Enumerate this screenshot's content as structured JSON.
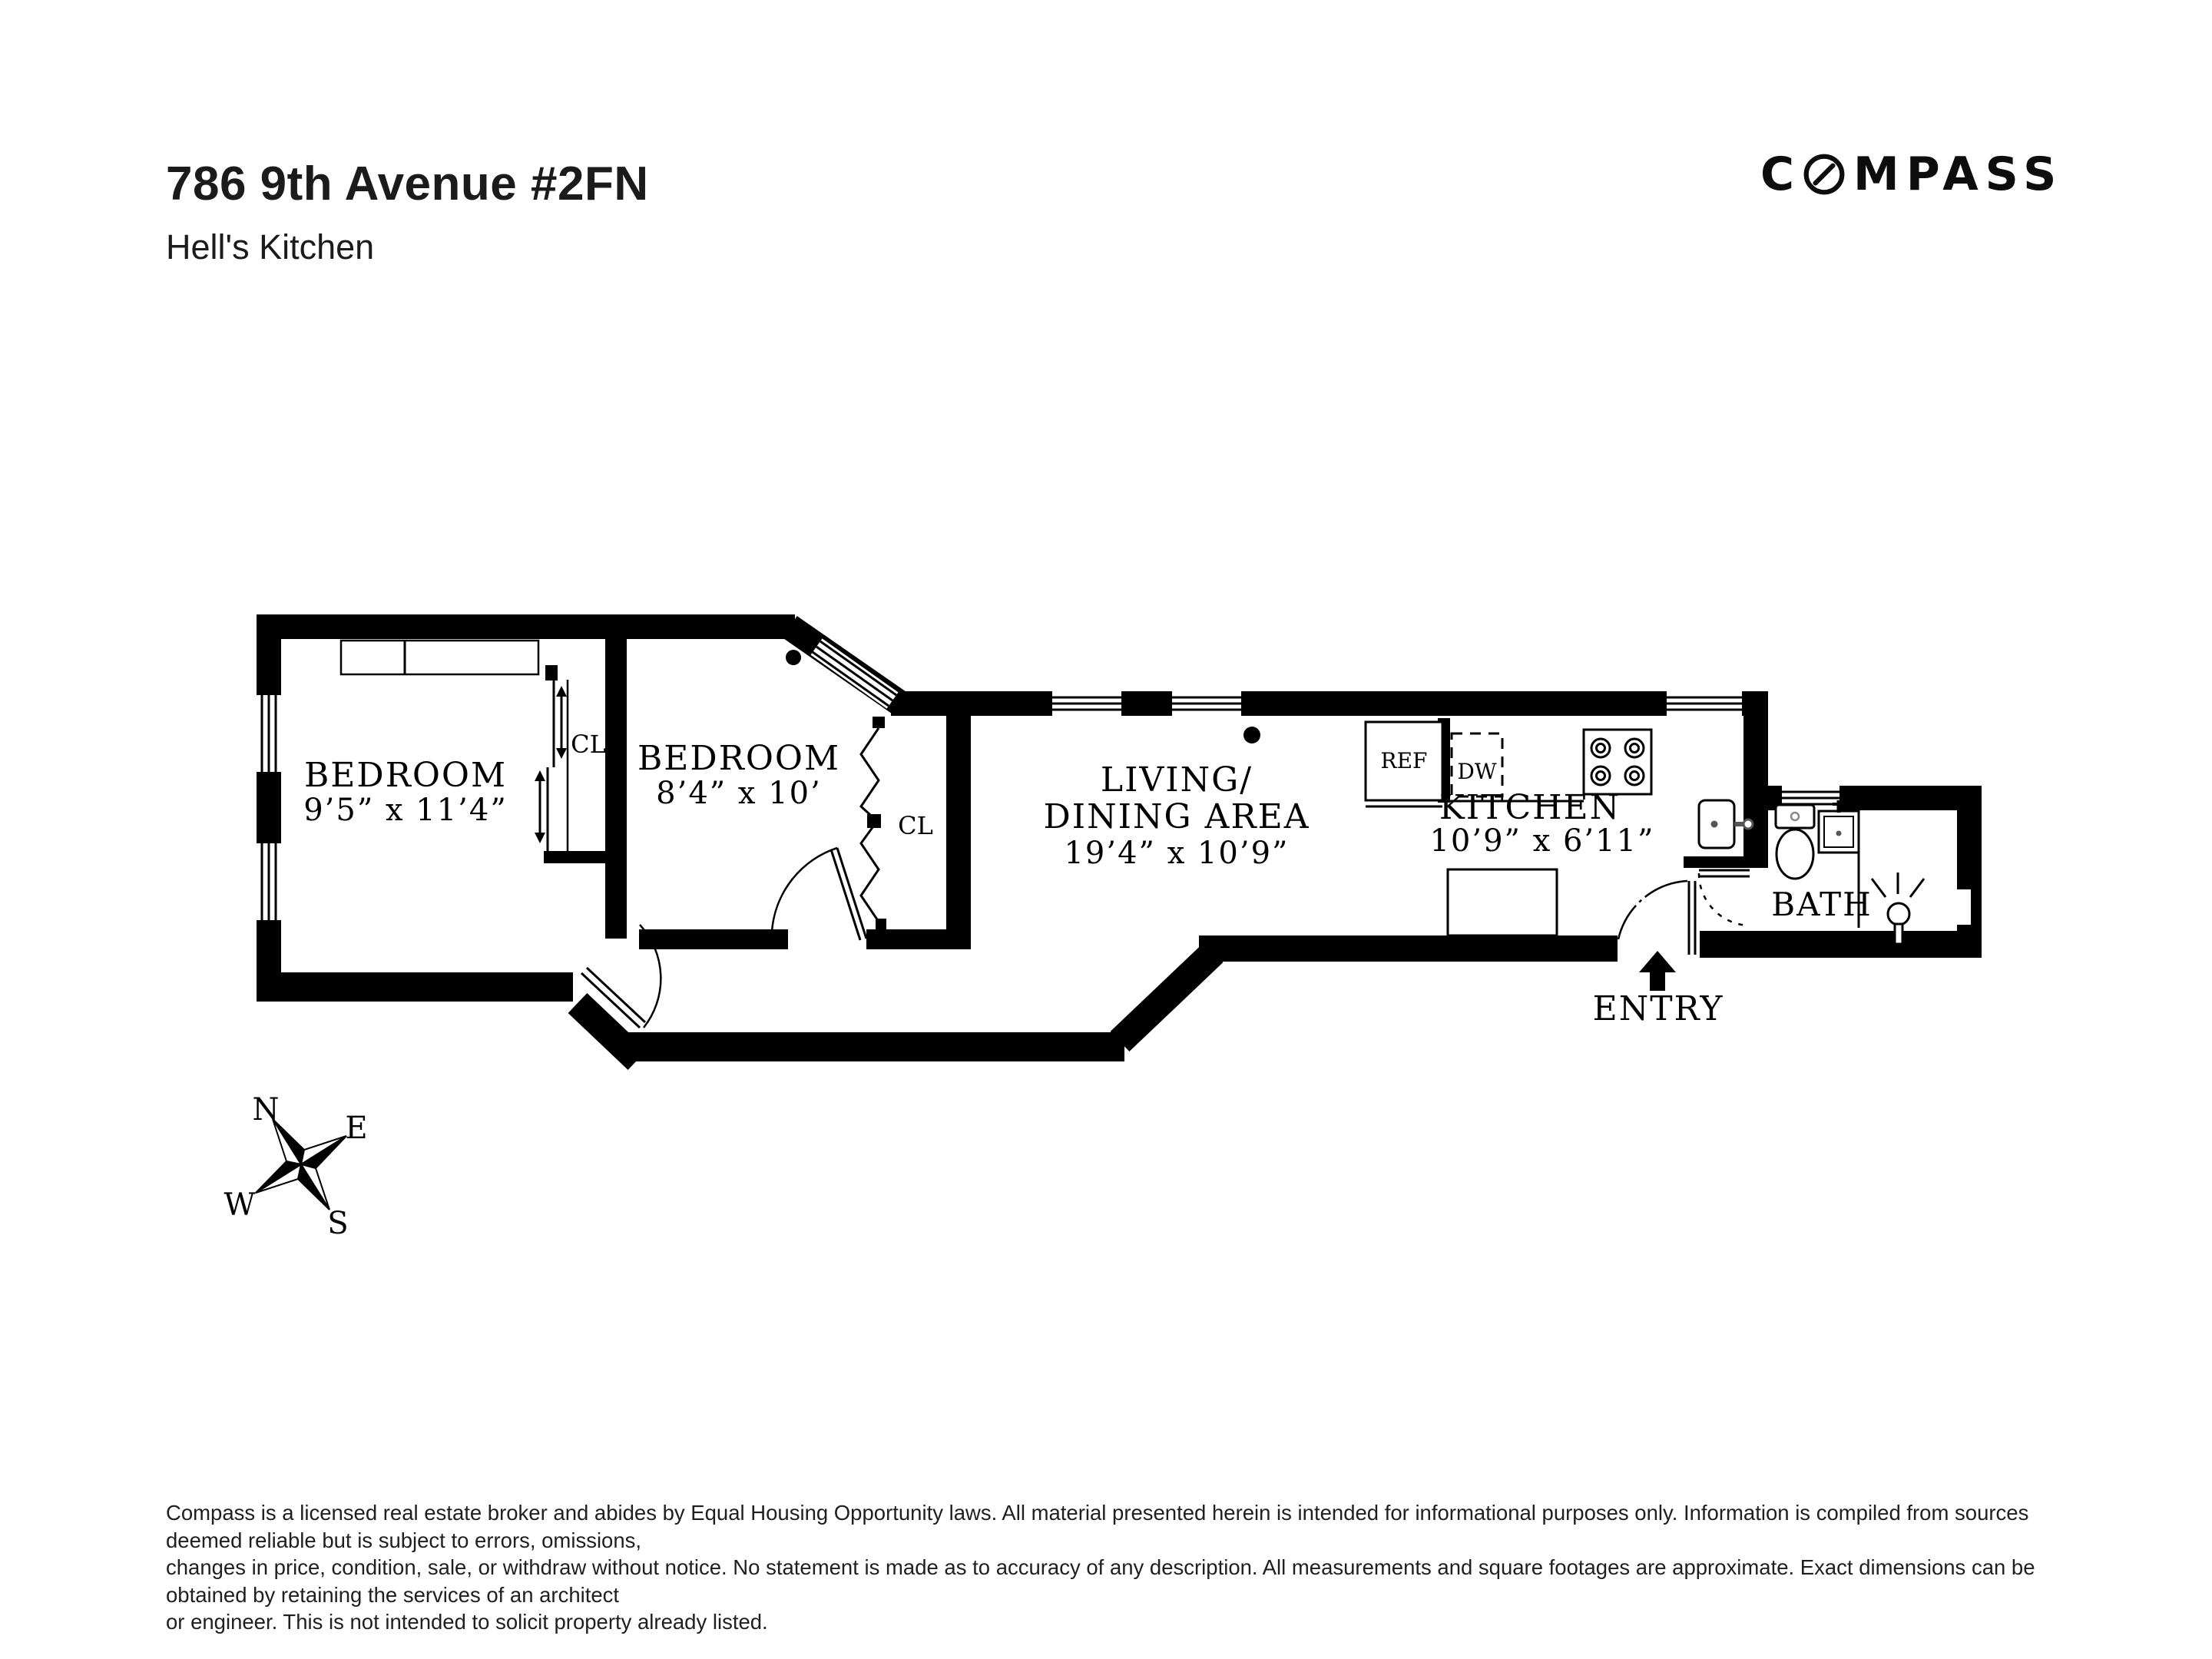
{
  "header": {
    "address": "786 9th Avenue #2FN",
    "neighborhood": "Hell's Kitchen"
  },
  "brand": {
    "logo_prefix": "C",
    "logo_suffix": "MPASS"
  },
  "floorplan": {
    "rooms": {
      "bedroom1": {
        "name": "BEDROOM",
        "dims": "9’5” x 11’4”"
      },
      "bedroom2": {
        "name": "BEDROOM",
        "dims": "8’4” x 10’"
      },
      "living": {
        "name_line1": "LIVING/",
        "name_line2": "DINING AREA",
        "dims": "19’4” x 10’9”"
      },
      "kitchen": {
        "name": "KITCHEN",
        "dims": "10’9” x 6’11”"
      },
      "bath": {
        "name": "BATH"
      }
    },
    "labels": {
      "closet_a": "CL",
      "closet_b": "CL",
      "refrigerator": "REF",
      "dishwasher": "DW",
      "entry": "ENTRY"
    },
    "compass_rose": {
      "n": "N",
      "e": "E",
      "s": "S",
      "w": "W"
    }
  },
  "footer": {
    "lines": [
      "Compass is a licensed real estate broker and abides by Equal Housing Opportunity laws. All material presented herein is intended for informational purposes only. Information is compiled from sources deemed reliable but is subject to errors, omissions,",
      "changes in price, condition, sale, or withdraw without notice. No statement is made as to accuracy of any description. All measurements and square footages are approximate. Exact dimensions can be obtained by retaining the services of an architect",
      "or engineer. This is not intended to solicit property already listed."
    ]
  },
  "colors": {
    "ink": "#000000",
    "text": "#1b1b1b",
    "background": "#ffffff"
  }
}
